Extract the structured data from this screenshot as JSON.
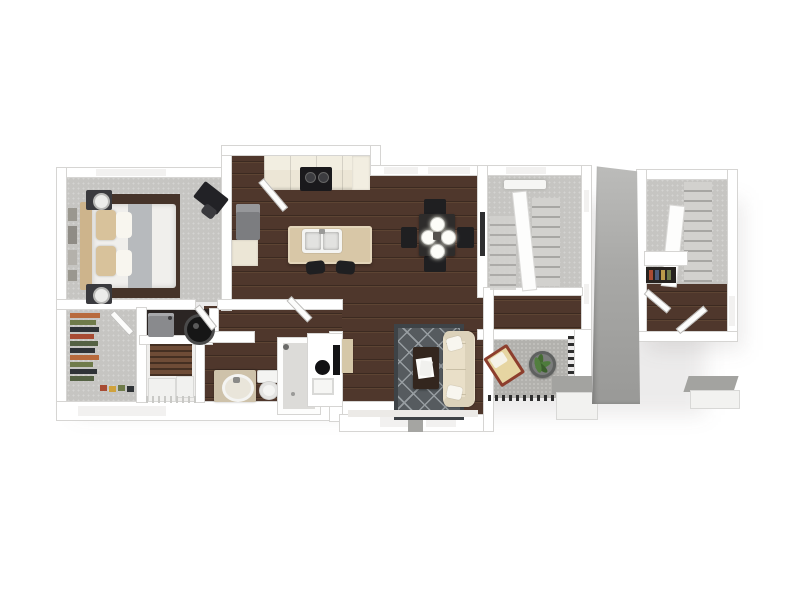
{
  "page": {
    "type": "3d-floor-plan-rendering",
    "background": "#ffffff",
    "visible_text": "none"
  },
  "colors": {
    "wall": "#ffffff",
    "wall_edge": "#d6d5d3",
    "wood": "#4f372c",
    "wood_dark": "#3c2a21",
    "wood_light": "#5d4433",
    "carpet": "#c6c5c2",
    "carpet_light": "#f1f0ee",
    "laundry_dark": "#2b2523",
    "counter": "#ece6d6",
    "counter_light": "#f2eee1",
    "island": "#d8c7a7",
    "stove": "#1a191c",
    "fridge": "#7c7d80",
    "fridge_top": "#96979a",
    "table": "#2e2c2b",
    "chair": "#1f1f21",
    "rug": "#565b5f",
    "rug_border": "#3e4347",
    "rug_line": "#979da1",
    "sofa": "#e9dfc8",
    "sofa_dark": "#dcd2ba",
    "pillow": "#f8f6ef",
    "coffee_table": "#33261e",
    "concrete": "#b2b1ad",
    "concrete_edge": "#9f9f9b",
    "railing": "#2e2e2e",
    "chair_frame": "#8d3e2d",
    "chair_cushion": "#e6d5a2",
    "plant": "#446b31",
    "planter": "#7a7c7b",
    "divider": "#a8a8a6",
    "louver": "#6e4c37",
    "washer": "#898a8d",
    "heater": "#161616",
    "vanity": "#cec2aa",
    "fixture": "#f4f4f2",
    "bed_frame": "#46342a",
    "duvet": "#f0efec",
    "blanket": "#b7babd",
    "headboard": "#cdb48c",
    "pillow_tan": "#d8c29b",
    "lamp": "#ececea",
    "nightstand": "#3a3a3e",
    "desk": "#222226",
    "frame_art": "#9a978f",
    "art": "#2e2e30",
    "cloth_a": "#b86a3c",
    "cloth_b": "#6f7b4a",
    "cloth_c": "#2f3337",
    "cloth_d": "#a84b33",
    "cloth_e": "#556244",
    "box_top": "#a3a3a0",
    "box_front": "#f2f2f0",
    "tv": "#141416",
    "console": "#d5c7a8",
    "tread_light": "#d2d1ce",
    "tread_dark": "#a7a6a3"
  },
  "floorplan": {
    "style": "top-down 3D render, white exterior walls, dark walnut plank flooring in living areas, gray carpet in bedroom/closet/stairs",
    "units": [
      {
        "name": "main-apartment",
        "rooms": [
          {
            "name": "bedroom",
            "floor": "carpet",
            "furniture": [
              "bed",
              "headboard",
              "gray-blanket",
              "tan-pillows",
              "nightstand-left",
              "nightstand-right",
              "table-lamps",
              "corner-desk",
              "desk-chair",
              "wall-frames",
              "window-top"
            ]
          },
          {
            "name": "walk-in-closet",
            "floor": "carpet",
            "furniture": [
              "hanging-clothes-rack",
              "shoe-row",
              "window-bottom",
              "open-door"
            ]
          },
          {
            "name": "laundry-closet",
            "floor": "dark",
            "furniture": [
              "washer",
              "water-heater"
            ]
          },
          {
            "name": "storage-closet",
            "furniture": [
              "louvered-cabinet",
              "storage-bins",
              "wire-shelf"
            ]
          },
          {
            "name": "bathroom",
            "furniture": [
              "vanity-with-oval-sink",
              "toilet",
              "shower",
              "cabinet-with-round-sink"
            ]
          },
          {
            "name": "entry-foyer",
            "floor": "wood",
            "furniture": [
              "entry-door"
            ]
          },
          {
            "name": "kitchen",
            "floor": "wood",
            "furniture": [
              "upper-cabinets",
              "range",
              "refrigerator",
              "base-counter",
              "island",
              "double-sink",
              "bar-stool",
              "bar-stool"
            ]
          },
          {
            "name": "dining-area",
            "floor": "wood",
            "furniture": [
              "square-table",
              "four-place-settings",
              "four-chairs"
            ]
          },
          {
            "name": "living-room",
            "floor": "wood",
            "furniture": [
              "sofa",
              "throw-pillows",
              "area-rug",
              "coffee-table",
              "papers",
              "wall-tv",
              "console-table",
              "windows-bottom"
            ]
          },
          {
            "name": "stair-hallway",
            "floor": "wood",
            "furniture": [
              "wall-art"
            ]
          },
          {
            "name": "stairwell",
            "floor": "carpet",
            "furniture": [
              "stair-flight-left",
              "stair-flight-right",
              "center-partition",
              "ceiling-light",
              "window-top",
              "side-windows"
            ]
          },
          {
            "name": "patio",
            "floor": "concrete",
            "furniture": [
              "lounge-chair",
              "potted-plant",
              "railing-right",
              "railing-bottom",
              "storage-box"
            ]
          }
        ]
      },
      {
        "name": "entry-stair-unit",
        "rooms": [
          {
            "name": "entry-stairs",
            "floor": "carpet-and-wood",
            "furniture": [
              "stair-flight",
              "center-partition",
              "half-wall",
              "shoe-shelf",
              "open-door",
              "open-door",
              "side-window"
            ]
          }
        ]
      }
    ],
    "exterior": [
      "gray-divider-wall",
      "outdoor-planter-box"
    ]
  }
}
